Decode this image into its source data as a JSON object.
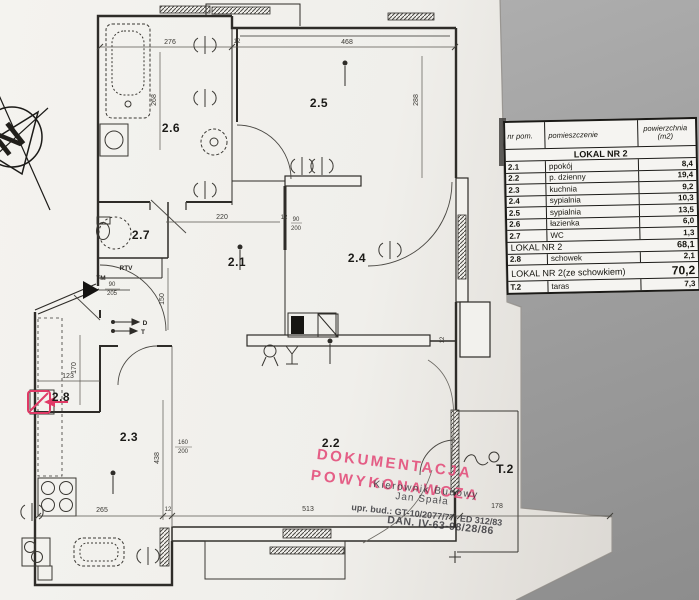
{
  "table": {
    "header": {
      "col1": "nr pom.",
      "col2": "pomieszczenie",
      "col3a": "powierzchnia",
      "col3b": "(m2)"
    },
    "section_title": "LOKAL NR 2",
    "rows": [
      {
        "nr": "2.1",
        "name": "ppokój",
        "area": "8,4"
      },
      {
        "nr": "2.2",
        "name": "p. dzienny",
        "area": "19,4"
      },
      {
        "nr": "2.3",
        "name": "kuchnia",
        "area": "9,2"
      },
      {
        "nr": "2.4",
        "name": "sypialnia",
        "area": "10,3"
      },
      {
        "nr": "2.5",
        "name": "sypialnia",
        "area": "13,5"
      },
      {
        "nr": "2.6",
        "name": "łazienka",
        "area": "6,0"
      },
      {
        "nr": "2.7",
        "name": "WC",
        "area": "1,3"
      }
    ],
    "subtotal": {
      "label": "LOKAL NR 2",
      "value": "68,1"
    },
    "storage_row": {
      "nr": "2.8",
      "name": "schowek",
      "area": "2,1"
    },
    "total": {
      "label": "LOKAL NR 2(ze schowkiem)",
      "value": "70,2"
    },
    "terrace_row": {
      "nr": "T.2",
      "name": "taras",
      "area": "7,3"
    }
  },
  "plan": {
    "room_labels": {
      "r21": "2.1",
      "r22": "2.2",
      "r23": "2.3",
      "r24": "2.4",
      "r25": "2.5",
      "r26": "2.6",
      "r27": "2.7",
      "r28": "2.8",
      "t2": "T.2"
    },
    "dims": {
      "top_left": "276",
      "top_wall": "12",
      "top_right": "468",
      "right_v": "288",
      "bath_v": "268",
      "hall": "220",
      "hall_wall": "12",
      "entry_v": "150",
      "storage": "123",
      "storage_v": "170",
      "kitchen_v": "438",
      "kitchen": "265",
      "kitchen_wall": "12",
      "bottom": "513",
      "terrace": "178",
      "terrace_wall": "12"
    },
    "fractions": {
      "hall_door_top": "90",
      "hall_door_bot": "200",
      "entry_door_top": "90",
      "entry_door_bot": "205",
      "balcony_door_top": "160",
      "balcony_door_bot": "200"
    },
    "annotations": {
      "rtv": "RTV",
      "tm": "TM",
      "d": "D",
      "t": "T",
      "north": "N"
    }
  },
  "stamps": {
    "pink_line1": "DOKUMENTACJA",
    "pink_line2": "POWYKONAWCZA",
    "black_line1": "Kierownik Budowy",
    "black_line2": "Jan Spała",
    "black_line3": "upr. bud.: GT-10/2077/77: ED 312/83",
    "black_line4": "DAN. IV-63-98/28/86",
    "pink_color": "#e24a78"
  }
}
